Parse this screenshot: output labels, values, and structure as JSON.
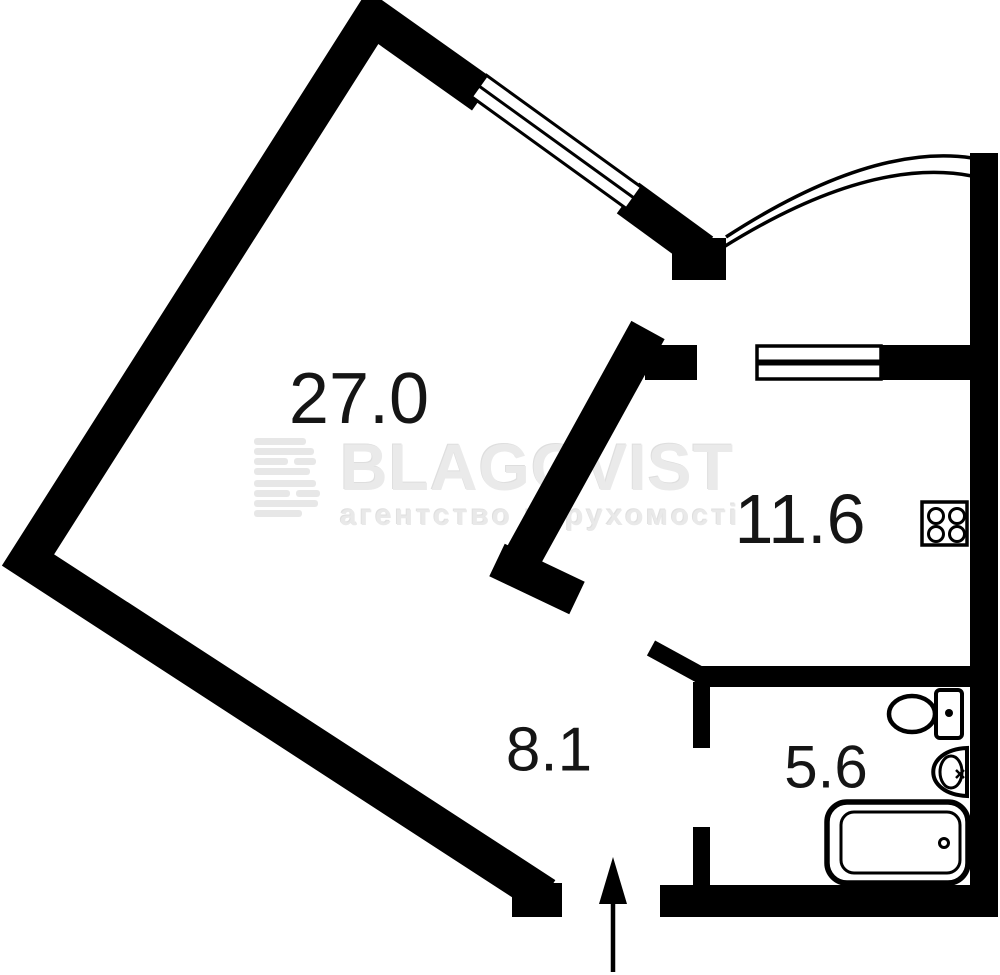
{
  "floorplan": {
    "title": "apartment-floor-plan",
    "rooms": [
      {
        "id": "living-room",
        "area": "27.0"
      },
      {
        "id": "kitchen",
        "area": "11.6"
      },
      {
        "id": "hallway",
        "area": "8.1"
      },
      {
        "id": "bathroom",
        "area": "5.6"
      }
    ],
    "fixtures": [
      "stove-icon",
      "toilet-icon",
      "sink-icon",
      "bathtub-icon",
      "entry-arrow-icon",
      "window-icon",
      "balcony-curve-wall"
    ],
    "watermark": {
      "brand": "BLAGOVIST",
      "tagline": "агентство нерухомості"
    },
    "colors": {
      "wall": "#000000",
      "label": "#151515",
      "watermark": "#eaeaea",
      "background": "#ffffff"
    }
  }
}
